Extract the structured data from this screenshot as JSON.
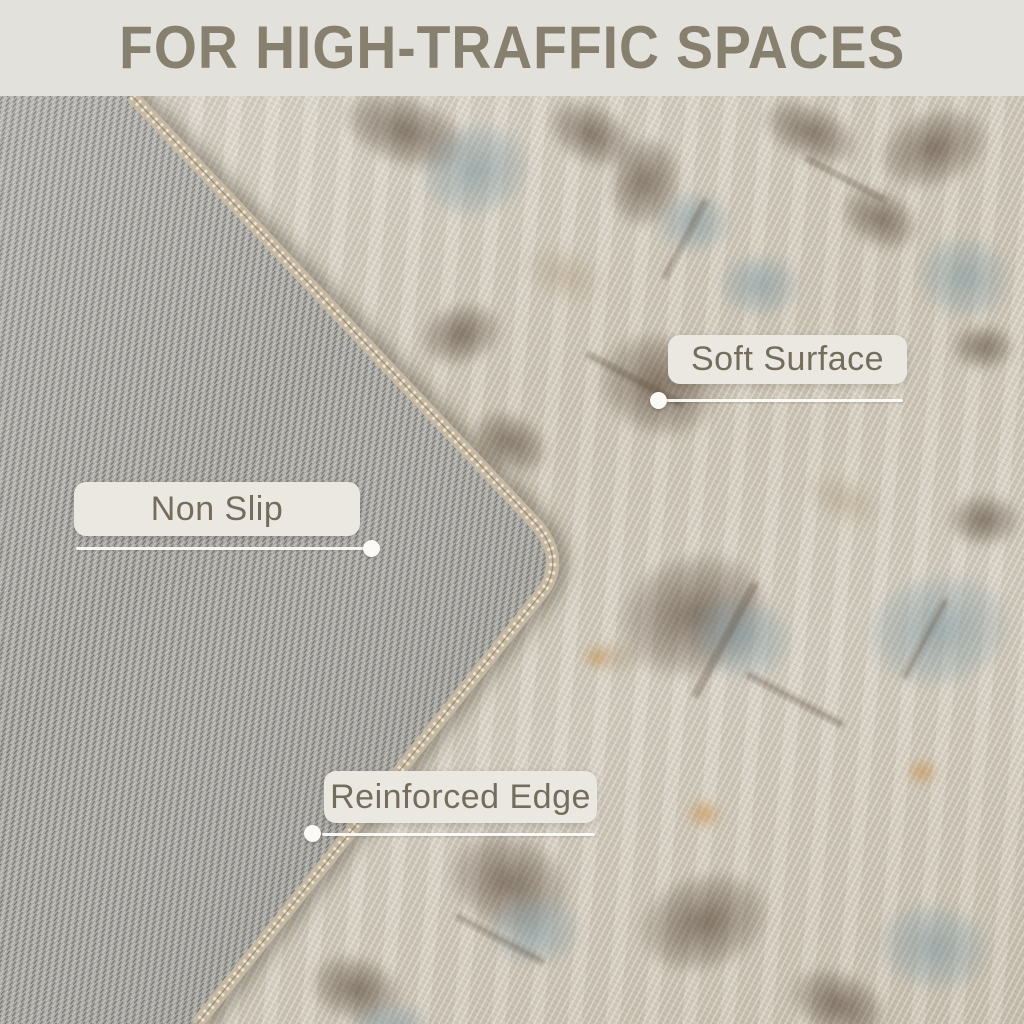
{
  "banner": {
    "title": "FOR HIGH-TRAFFIC SPACES"
  },
  "callouts": [
    {
      "label": "Soft Surface"
    },
    {
      "label": "Non Slip"
    },
    {
      "label": "Reinforced Edge"
    }
  ],
  "colors": {
    "banner_bg": "#e3e1dc",
    "banner_text": "#87806f",
    "label_bg": "#ebe8e2",
    "label_text": "#746c5d",
    "connector_white": "#fbfaf7",
    "backing_gray": "#a9a8a3",
    "rug_beige": "#cfc7b9",
    "motif_brown": "#4d3b2c",
    "motif_blue": "#829aa2",
    "motif_orange": "#c6924d",
    "stitch_edge": "#c9bba4"
  }
}
